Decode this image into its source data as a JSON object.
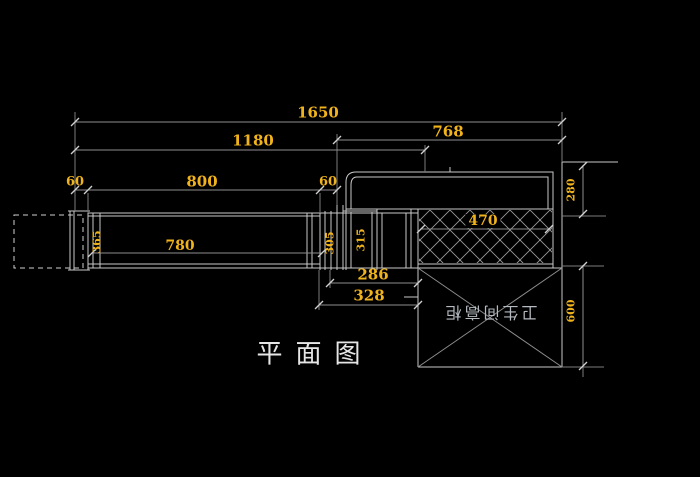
{
  "drawing": {
    "title": "平面图",
    "cabinet_label": "卫生间高柜",
    "dims": {
      "top_width": "1650",
      "mid_width": "1180",
      "right_width": "768",
      "seg_left": "60",
      "seg_main": "800",
      "seg_right": "60",
      "inner_length": "780",
      "counter_width": "470",
      "gap_small": "286",
      "gap_large": "328",
      "depth_top": "280",
      "depth_bottom": "600",
      "v_left": "365",
      "v_mid": "305",
      "v_box": "315"
    },
    "colors": {
      "background": "#000000",
      "dim_text": "#f0b31c",
      "geometry_line": "#c9c9c9",
      "dim_line": "#8e8e8e",
      "tick": "#d0d0d0",
      "label_text": "#b4bac0",
      "title_text": "#e6e6e6"
    }
  }
}
